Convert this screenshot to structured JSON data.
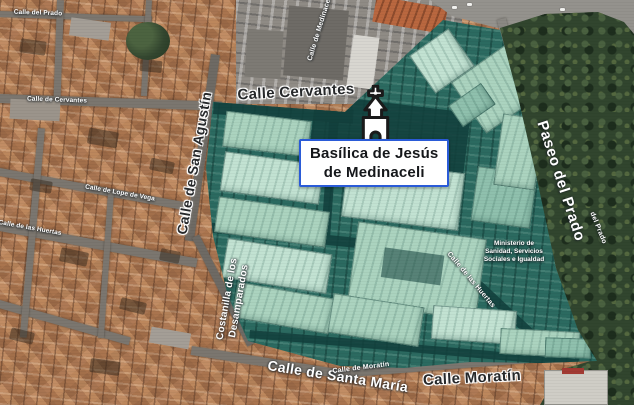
{
  "map": {
    "poi": {
      "name_line1": "Basílica de Jesús",
      "name_line2": "de Medinaceli",
      "marker": "church-icon"
    },
    "streets": {
      "cervantes": "Calle Cervantes",
      "san_agustin": "Calle de San Agustín",
      "paseo_del_prado": "Paseo del Prado",
      "costanilla_line1": "Costanilla de los",
      "costanilla_line2": "Desamparados",
      "santa_maria": "Calle de Santa María",
      "moratin": "Calle Moratín",
      "moratin_small": "Calle de Moratín",
      "medinaceli_small": "Calle de Medinaceli",
      "del_prado_small": "del Prado",
      "huertas_small": "Calle de las Huertas",
      "cervantes_small": "Calle de Cervantes",
      "lope_de_vega_small": "Calle de Lope de Vega",
      "prado_street_small": "Calle del Prado"
    },
    "buildings": {
      "ministry_line1": "Ministerio de",
      "ministry_line2": "Sanidad, Servicios",
      "ministry_line3": "Sociales e Igualdad"
    },
    "colors": {
      "highlight_teal": "#2b6a60",
      "highlight_building": "#abd3bf",
      "highlight_street_dark": "#12403c",
      "label_box_border": "#2a5bd7",
      "label_box_bg": "#ffffff",
      "trees_green": "#31452e",
      "rooftop_terracotta": "#b5825f",
      "road_grey": "#7b766f"
    }
  }
}
